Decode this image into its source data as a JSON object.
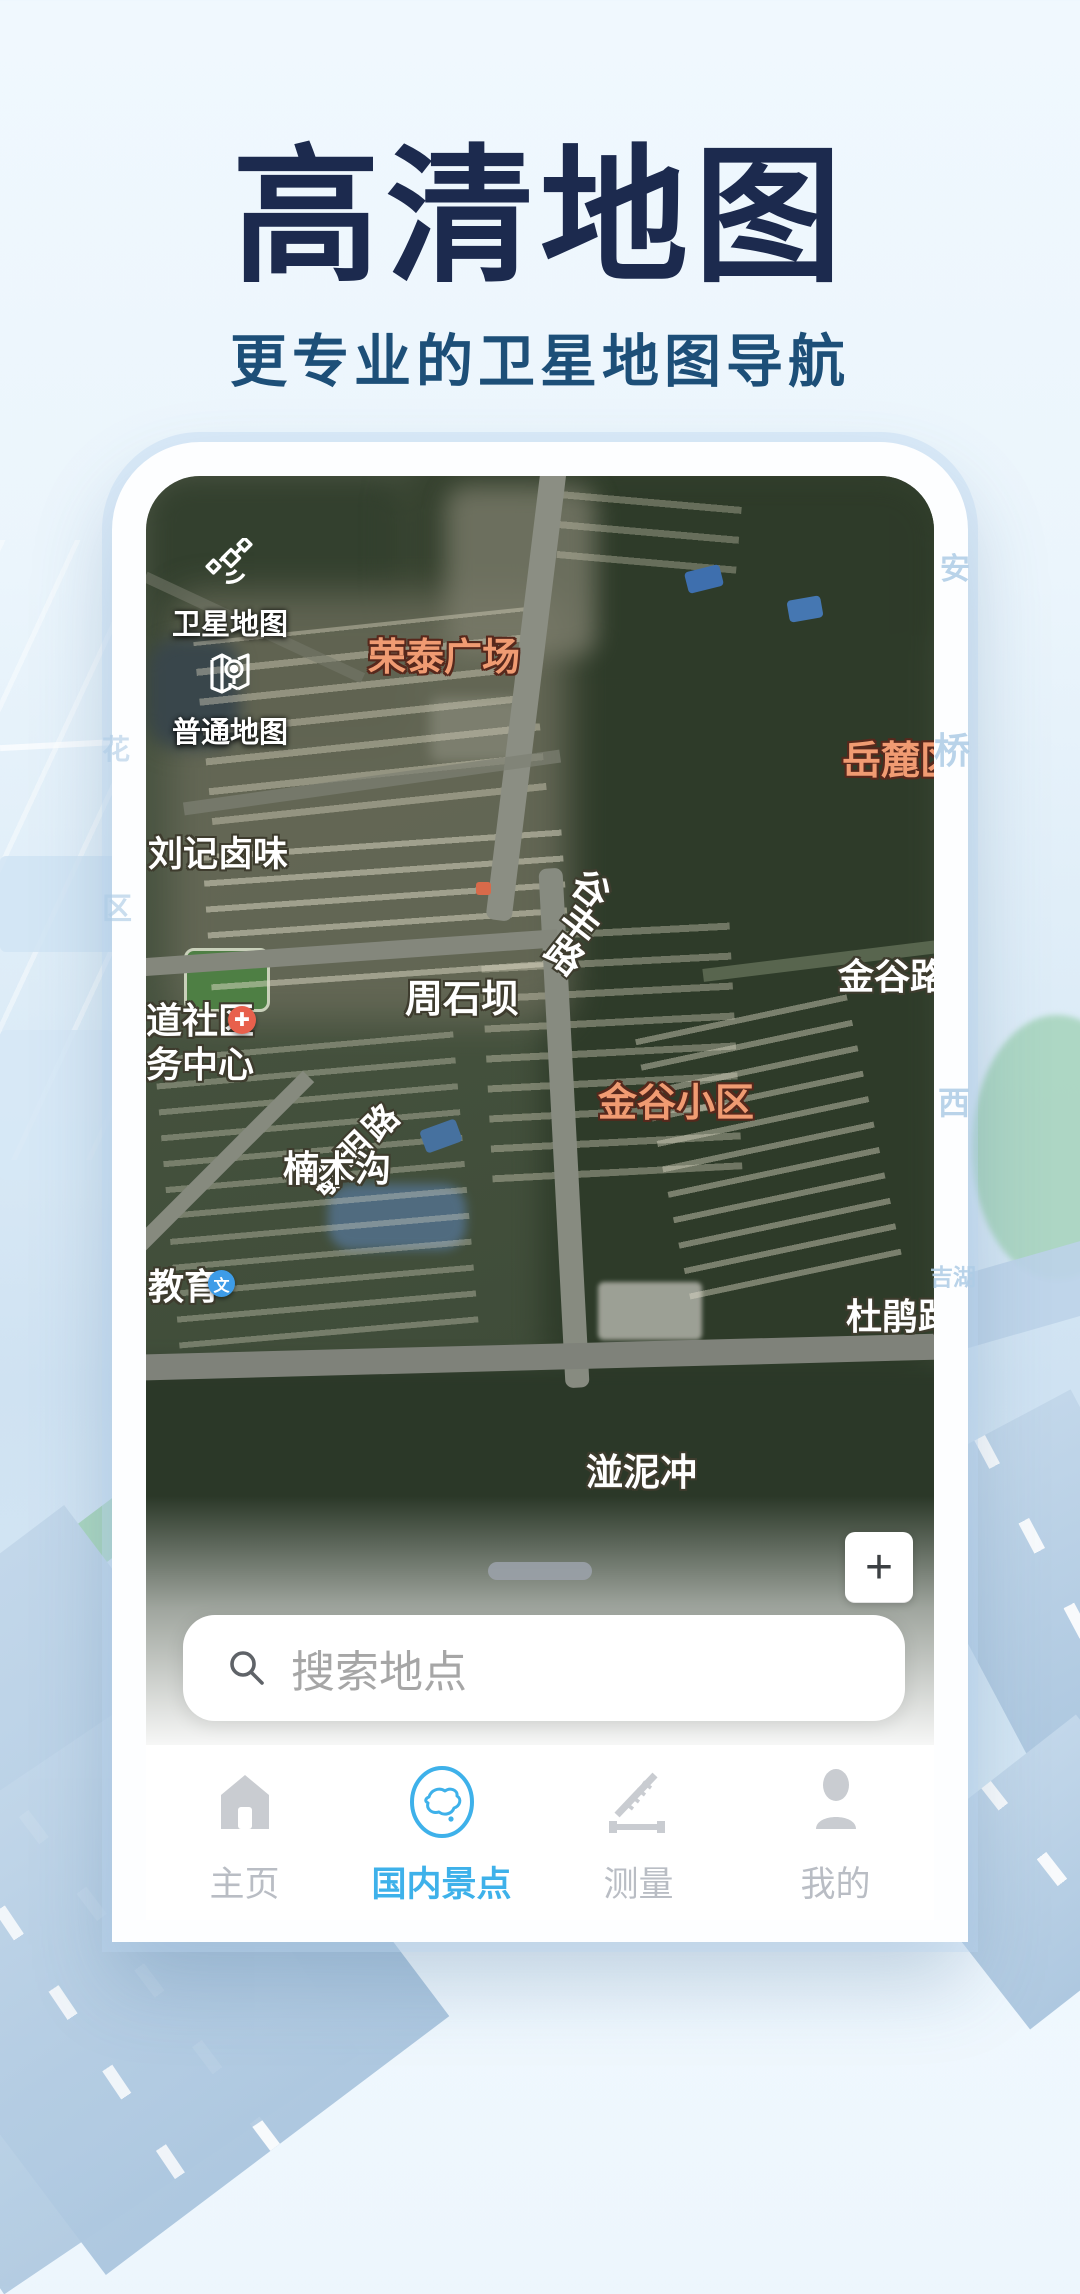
{
  "hero": {
    "title": "高清地图",
    "subtitle": "更专业的卫星地图导航"
  },
  "map": {
    "controls": [
      {
        "label": "卫星地图",
        "icon": "satellite-icon"
      },
      {
        "label": "普通地图",
        "icon": "normal-map-icon"
      }
    ],
    "labels": {
      "rongtai": "荣泰广场",
      "yuelu": "岳麓区",
      "liuji": "刘记卤味",
      "gufeng": [
        "谷",
        "丰",
        "路"
      ],
      "zhoushiba": "周石坝",
      "jingu_road": "金谷路",
      "jingu_estate": "金谷小区",
      "shequ_line1": "道社区",
      "shequ_line2": "务中心",
      "minming": [
        "路",
        "明",
        "敏"
      ],
      "nanmugou": "楠木沟",
      "jiaoyu": "教育",
      "school_glyph": "文",
      "dujuan": "杜鹃路",
      "bannichong": "湴泥冲"
    },
    "zoom_in_label": "+"
  },
  "search": {
    "placeholder": "搜索地点"
  },
  "nav": {
    "items": [
      {
        "label": "主页",
        "icon": "home-icon",
        "active": false
      },
      {
        "label": "国内景点",
        "icon": "china-map-icon",
        "active": true
      },
      {
        "label": "测量",
        "icon": "measure-icon",
        "active": false
      },
      {
        "label": "我的",
        "icon": "profile-icon",
        "active": false
      }
    ]
  },
  "background": {
    "faint_labels": {
      "an": "安",
      "qiao": "桥",
      "xi": "西",
      "jihu": "吉湖",
      "hua": "花",
      "qu": "区"
    }
  },
  "colors": {
    "title": "#1c2a4e",
    "subtitle": "#1d4f78",
    "nav_active": "#3eb1ea",
    "map_label_orange": "#f09b72"
  }
}
